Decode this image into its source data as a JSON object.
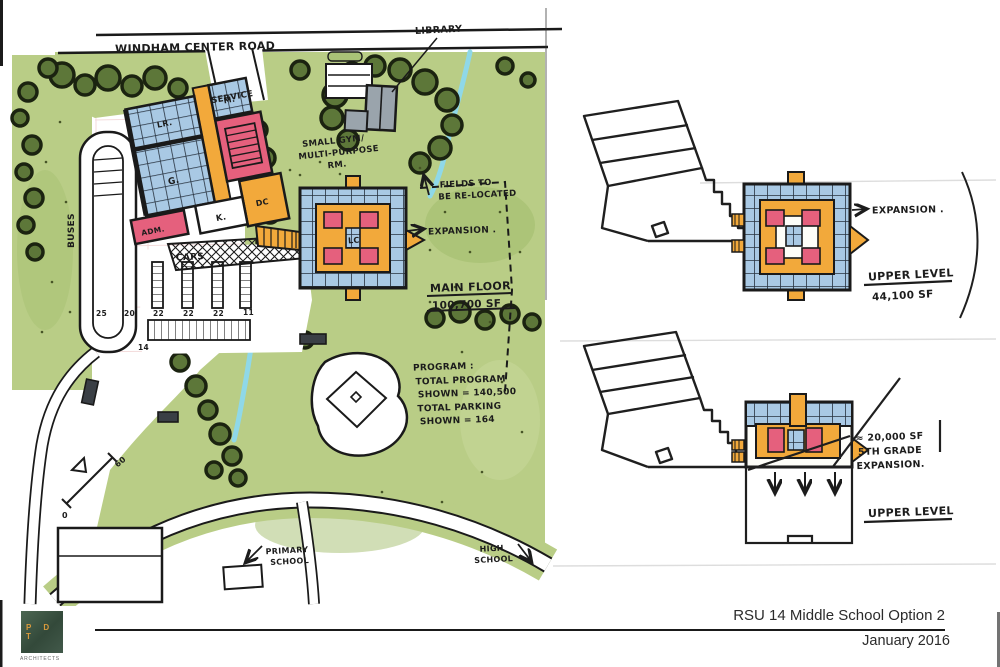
{
  "palette": {
    "paper": "#ffffff",
    "field_green": "#b9cd86",
    "field_green_dark": "#a3bd6e",
    "tree_green": "#5d7739",
    "tree_outline": "#1b2310",
    "classroom_blue": "#a9c9e4",
    "circulation_orange": "#f2a93b",
    "gym_pink": "#e5607d",
    "library_gray": "#9aa4ac",
    "stream_blue": "#8fd8e8",
    "ink": "#1a1a1a"
  },
  "site_plan": {
    "road_label": "WINDHAM CENTER ROAD",
    "library_label": "LIBRARY",
    "service_label": "SERVICE",
    "gym_note_line1": "SMALL GYM/",
    "gym_note_line2": "MULTI-PURPOSE",
    "gym_note_line3": "RM.",
    "fields_note_line1": "FIELDS TO",
    "fields_note_line2": "BE RE-LOCATED",
    "expansion_label": "EXPANSION .",
    "main_floor_label": "MAIN FLOOR",
    "main_floor_area": "100,700 SF",
    "program": {
      "heading": "PROGRAM :",
      "line1": "TOTAL PROGRAM",
      "line2": "SHOWN = 140,500",
      "line3": "TOTAL PARKING",
      "line4": "SHOWN = 164"
    },
    "buses_label": "BUSES",
    "cars_label": "CARS",
    "parking_counts": [
      "25",
      "20",
      "22",
      "22",
      "22",
      "11"
    ],
    "parking_count_lower": "14",
    "rooms": {
      "lr": "LR.",
      "m": "M.",
      "g": "G.",
      "k": "K.",
      "adm": "ADM.",
      "dc": "DC",
      "lc": "LC"
    },
    "scale": {
      "start": "0",
      "end": "60"
    },
    "primary_school_line1": "PRIMARY",
    "primary_school_line2": "SCHOOL",
    "high_school_line1": "HIGH",
    "high_school_line2": "SCHOOL"
  },
  "upper_level_diagram": {
    "expansion_label": "EXPANSION .",
    "level_label": "UPPER LEVEL",
    "area": "44,100 SF"
  },
  "fifth_grade_diagram": {
    "area": "≈ 20,000 SF",
    "note_line1": "5TH GRADE",
    "note_line2": "EXPANSION.",
    "level_label": "UPPER LEVEL"
  },
  "title_block": {
    "project_title": "RSU 14 Middle School Option 2",
    "date": "January 2016",
    "logo_letters": "P D T",
    "logo_caption": "ARCHITECTS"
  }
}
